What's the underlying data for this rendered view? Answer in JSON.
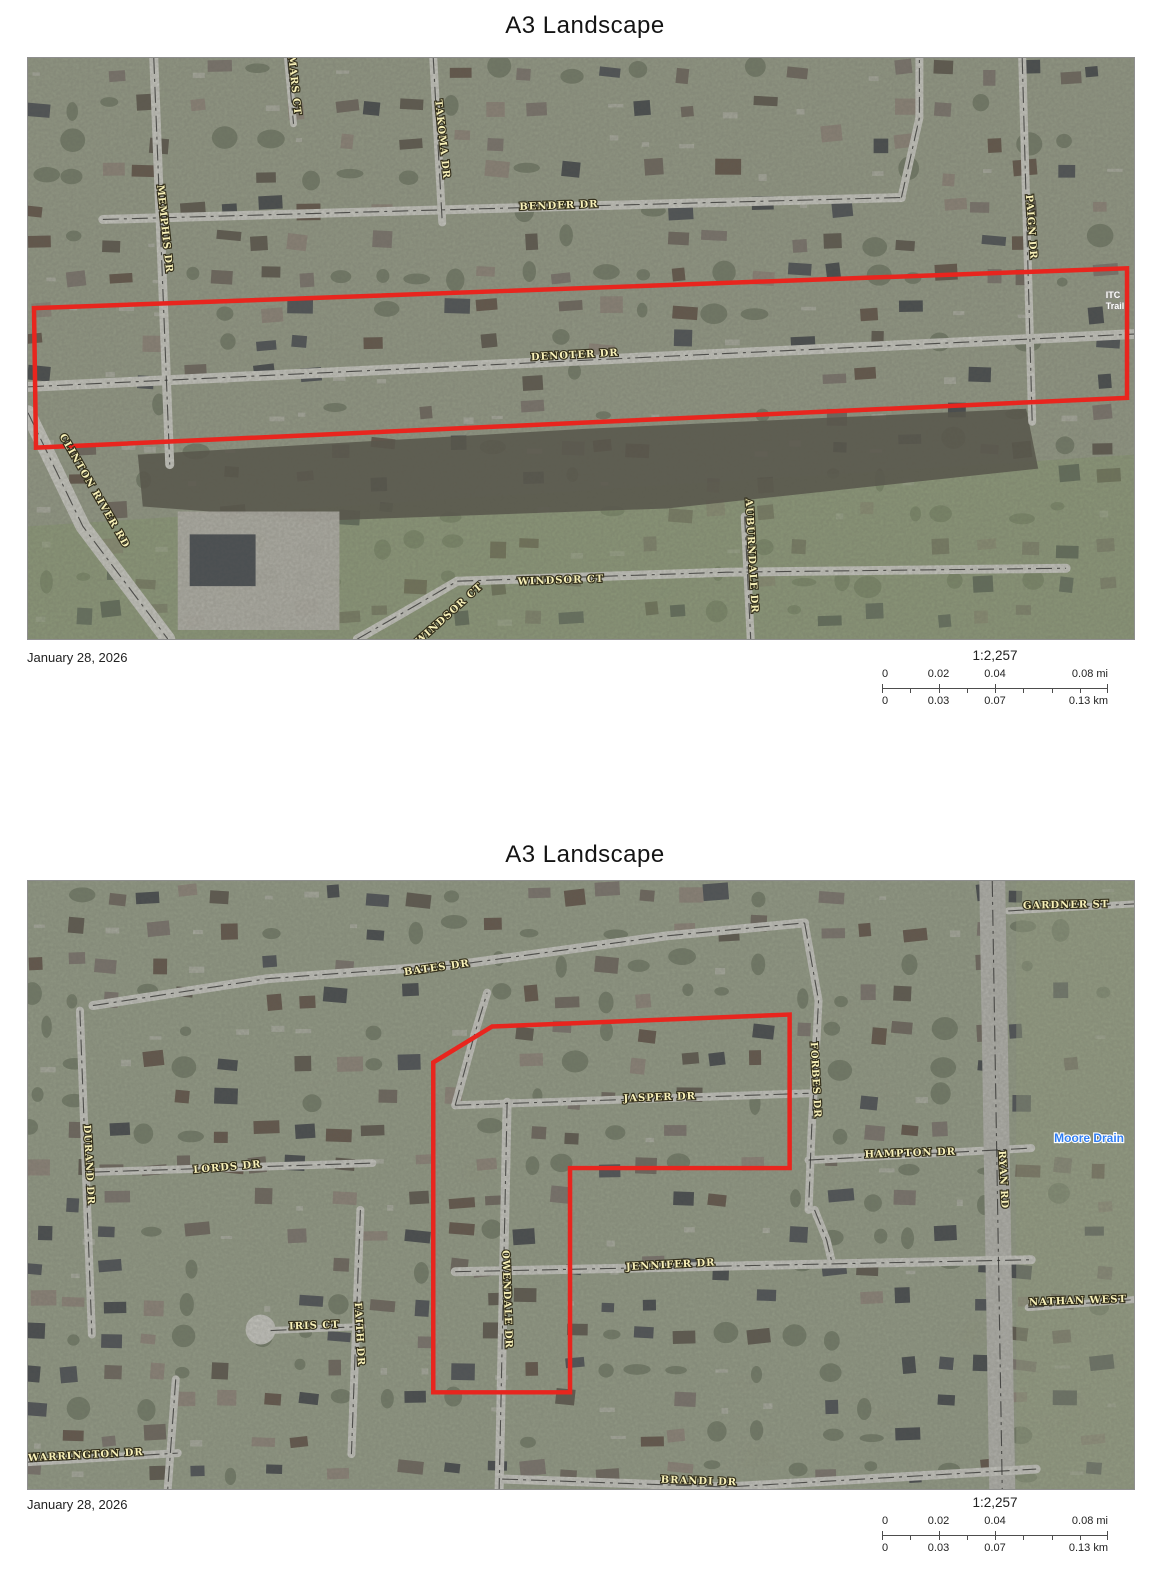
{
  "outline_color": "#e8251e",
  "pages": [
    {
      "title": "A3 Landscape",
      "date": "January 28, 2026",
      "scale_text": "1:2,257",
      "scalebar": {
        "mi": [
          "0",
          "0.02",
          "0.04",
          "0.08 mi"
        ],
        "km": [
          "0",
          "0.03",
          "0.07",
          "0.13 km"
        ]
      }
    },
    {
      "title": "A3 Landscape",
      "date": "January 28, 2026",
      "scale_text": "1:2,257",
      "scalebar": {
        "mi": [
          "0",
          "0.02",
          "0.04",
          "0.08 mi"
        ],
        "km": [
          "0",
          "0.03",
          "0.07",
          "0.13 km"
        ]
      }
    }
  ],
  "maps": [
    {
      "width": 1108,
      "height": 583,
      "seed": 17,
      "base": "#8d937f",
      "road_color": "#cbcbc4",
      "house_colors": [
        "#474b50",
        "#585249",
        "#6a635a",
        "#3e4246",
        "#78716a",
        "#8c8277",
        "#5d4f44"
      ],
      "patches": [
        {
          "points": [
            [
              0,
              470
            ],
            [
              1108,
              398
            ],
            [
              1108,
              583
            ],
            [
              0,
              583
            ]
          ],
          "fill": "#879c6c",
          "opacity": 0.45
        },
        {
          "points": [
            [
              110,
              398
            ],
            [
              560,
              372
            ],
            [
              1000,
              352
            ],
            [
              1012,
              412
            ],
            [
              640,
              452
            ],
            [
              300,
              464
            ],
            [
              115,
              450
            ]
          ],
          "fill": "#565449",
          "opacity": 0.88
        },
        {
          "points": [
            [
              150,
              455
            ],
            [
              312,
              455
            ],
            [
              312,
              574
            ],
            [
              150,
              574
            ]
          ],
          "fill": "#b5b3ab",
          "opacity": 0.92
        },
        {
          "points": [
            [
              162,
              478
            ],
            [
              228,
              478
            ],
            [
              228,
              530
            ],
            [
              162,
              530
            ]
          ],
          "fill": "#474c51",
          "opacity": 1
        }
      ],
      "roads": [
        {
          "pts": [
            [
              75,
              162
            ],
            [
              500,
              150
            ],
            [
              875,
              140
            ]
          ],
          "w": 9
        },
        {
          "pts": [
            [
              875,
              140
            ],
            [
              893,
              60
            ],
            [
              893,
              0
            ]
          ],
          "w": 8
        },
        {
          "pts": [
            [
              0,
              330
            ],
            [
              1108,
              277
            ]
          ],
          "w": 10
        },
        {
          "pts": [
            [
              126,
              0
            ],
            [
              142,
              408
            ]
          ],
          "w": 9
        },
        {
          "pts": [
            [
              406,
              0
            ],
            [
              415,
              165
            ]
          ],
          "w": 8
        },
        {
          "pts": [
            [
              260,
              0
            ],
            [
              266,
              66
            ]
          ],
          "w": 7
        },
        {
          "pts": [
            [
              996,
              0
            ],
            [
              1006,
              365
            ]
          ],
          "w": 8
        },
        {
          "pts": [
            [
              0,
              356
            ],
            [
              55,
              470
            ],
            [
              140,
              583
            ]
          ],
          "w": 15
        },
        {
          "pts": [
            [
              330,
              583
            ],
            [
              370,
              560
            ],
            [
              430,
              525
            ]
          ],
          "w": 9
        },
        {
          "pts": [
            [
              430,
              525
            ],
            [
              700,
              516
            ],
            [
              1040,
              512
            ]
          ],
          "w": 9
        },
        {
          "pts": [
            [
              718,
              460
            ],
            [
              724,
              583
            ]
          ],
          "w": 8
        }
      ],
      "labels": [
        {
          "text": "MARS CT",
          "x": 264,
          "y": 28,
          "rot": 84
        },
        {
          "text": "TAKOMA DR",
          "x": 412,
          "y": 82,
          "rot": 84
        },
        {
          "text": "MEMPHIS DR",
          "x": 134,
          "y": 172,
          "rot": 84
        },
        {
          "text": "BENDER DR",
          "x": 532,
          "y": 151,
          "rot": -2
        },
        {
          "text": "PAIGN DR",
          "x": 1002,
          "y": 170,
          "rot": 86
        },
        {
          "text": "ITC",
          "x": 1087,
          "y": 241,
          "cls": "white small"
        },
        {
          "text": "Trail",
          "x": 1089,
          "y": 252,
          "cls": "white small"
        },
        {
          "text": "DENOTER DR",
          "x": 548,
          "y": 301,
          "rot": -3
        },
        {
          "text": "CLINTON RIVER RD",
          "x": 64,
          "y": 436,
          "rot": 60
        },
        {
          "text": "WINDSOR CT",
          "x": 424,
          "y": 560,
          "rot": -42
        },
        {
          "text": "WINDSOR CT",
          "x": 534,
          "y": 527,
          "rot": -2
        },
        {
          "text": "AUBURNDALE DR",
          "x": 722,
          "y": 500,
          "rot": 87
        }
      ],
      "outline": [
        [
          6,
          251
        ],
        [
          1101,
          211
        ],
        [
          1101,
          341
        ],
        [
          8,
          391
        ]
      ]
    },
    {
      "width": 1108,
      "height": 610,
      "seed": 41,
      "base": "#8e9680",
      "road_color": "#c9c9c3",
      "house_colors": [
        "#474b50",
        "#585249",
        "#6a635a",
        "#3e4246",
        "#78716a",
        "#8c8277",
        "#5d4f44"
      ],
      "patches": [
        {
          "points": [
            [
              990,
              0
            ],
            [
              1108,
              0
            ],
            [
              1108,
              610
            ],
            [
              990,
              610
            ]
          ],
          "fill": "#97a184",
          "opacity": 0.5
        },
        {
          "circle": true,
          "cx": 233,
          "cy": 450,
          "r": 15,
          "fill": "#c9c9c3"
        }
      ],
      "roads": [
        {
          "pts": [
            [
              982,
              30
            ],
            [
              1108,
              23
            ]
          ],
          "w": 7
        },
        {
          "pts": [
            [
              65,
              125
            ],
            [
              240,
              98
            ],
            [
              430,
              84
            ],
            [
              640,
              55
            ],
            [
              778,
              42
            ]
          ],
          "w": 9
        },
        {
          "pts": [
            [
              778,
              42
            ],
            [
              792,
              120
            ],
            [
              785,
              250
            ],
            [
              782,
              330
            ]
          ],
          "w": 8
        },
        {
          "pts": [
            [
              52,
              130
            ],
            [
              64,
              455
            ]
          ],
          "w": 8
        },
        {
          "pts": [
            [
              66,
              292
            ],
            [
              345,
              283
            ]
          ],
          "w": 8
        },
        {
          "pts": [
            [
              428,
              225
            ],
            [
              782,
              213
            ]
          ],
          "w": 8
        },
        {
          "pts": [
            [
              428,
              225
            ],
            [
              447,
              155
            ],
            [
              460,
              112
            ]
          ],
          "w": 8
        },
        {
          "pts": [
            [
              782,
              280
            ],
            [
              1005,
              268
            ]
          ],
          "w": 8
        },
        {
          "pts": [
            [
              966,
              0
            ],
            [
              976,
              610
            ]
          ],
          "w": 26,
          "color": "#b4b4ae"
        },
        {
          "pts": [
            [
              428,
              392
            ],
            [
              1005,
              380
            ]
          ],
          "w": 9
        },
        {
          "pts": [
            [
              480,
              222
            ],
            [
              472,
              610
            ]
          ],
          "w": 9
        },
        {
          "pts": [
            [
              333,
              330
            ],
            [
              324,
              575
            ]
          ],
          "w": 8
        },
        {
          "pts": [
            [
              243,
              451
            ],
            [
              335,
              447
            ]
          ],
          "w": 7
        },
        {
          "pts": [
            [
              1002,
              428
            ],
            [
              1108,
              420
            ]
          ],
          "w": 7
        },
        {
          "pts": [
            [
              0,
              583
            ],
            [
              150,
              574
            ]
          ],
          "w": 8
        },
        {
          "pts": [
            [
              148,
              500
            ],
            [
              140,
              610
            ]
          ],
          "w": 8
        },
        {
          "pts": [
            [
              475,
              600
            ],
            [
              700,
              608
            ],
            [
              1010,
              590
            ]
          ],
          "w": 9
        },
        {
          "pts": [
            [
              788,
              330
            ],
            [
              800,
              360
            ],
            [
              805,
              381
            ]
          ],
          "w": 8
        }
      ],
      "labels": [
        {
          "text": "GARDNER ST",
          "x": 1040,
          "y": 27,
          "rot": -1
        },
        {
          "text": "BATES DR",
          "x": 410,
          "y": 90,
          "rot": -8
        },
        {
          "text": "DURAND DR",
          "x": 58,
          "y": 285,
          "rot": 87
        },
        {
          "text": "LORDS DR",
          "x": 200,
          "y": 290,
          "rot": -5
        },
        {
          "text": "JASPER DR",
          "x": 633,
          "y": 220,
          "rot": -2
        },
        {
          "text": "FORBES DR",
          "x": 786,
          "y": 200,
          "rot": 87
        },
        {
          "text": "HAMPTON DR",
          "x": 884,
          "y": 276,
          "rot": -2
        },
        {
          "text": "RYAN RD",
          "x": 974,
          "y": 300,
          "rot": 87
        },
        {
          "text": "Moore Drain",
          "x": 1063,
          "y": 262,
          "cls": "blue"
        },
        {
          "text": "JENNIFER DR",
          "x": 644,
          "y": 388,
          "rot": -3
        },
        {
          "text": "OWENDALE DR",
          "x": 477,
          "y": 420,
          "rot": 88
        },
        {
          "text": "FAITH DR",
          "x": 329,
          "y": 455,
          "rot": 87
        },
        {
          "text": "IRIS CT",
          "x": 287,
          "y": 449,
          "rot": -2
        },
        {
          "text": "NATHAN WEST",
          "x": 1052,
          "y": 424,
          "rot": -2
        },
        {
          "text": "WARRINGTON DR",
          "x": 58,
          "y": 579,
          "rot": -3
        },
        {
          "text": "BRANDI DR",
          "x": 672,
          "y": 605,
          "rot": 2
        }
      ],
      "outline": [
        [
          465,
          146
        ],
        [
          763,
          134
        ],
        [
          763,
          288
        ],
        [
          543,
          288
        ],
        [
          543,
          513
        ],
        [
          406,
          513
        ],
        [
          406,
          182
        ]
      ]
    }
  ]
}
